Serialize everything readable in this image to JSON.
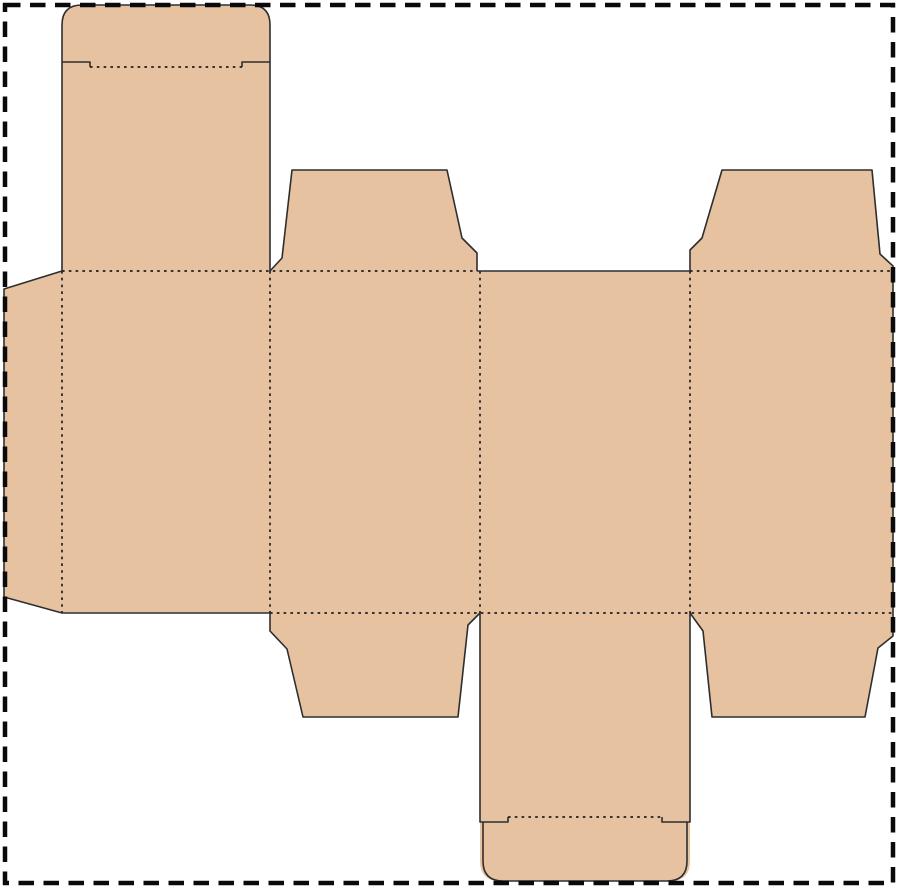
{
  "figure": {
    "kind": "packaging-dieline",
    "label": "tuck-end box dieline blank"
  },
  "colors": {
    "background": "#ffffff",
    "board": "#e6c2a1",
    "cut_line": "#2e2e2e",
    "fold_line": "#1f1f1f",
    "page_border": "#0a0a0a"
  },
  "fills": {
    "top_lid_tuck": "M62,271 L62,25 Q62,5 82,5 L250,5 Q270,5 270,25 L270,271 Z",
    "top_dust_flap_left": "M270,271 L282,258 L292,170 L447,170 L462,238 L477,253 L477,271 Z",
    "top_dust_flap_right": "M690,271 L690,250 L702,238 L722,170 L872,170 L880,254 L893,266 L893,271 Z",
    "main_panel_row": "M62,271 L893,271 L893,613 L62,613 Z",
    "glue_tab": "M62,271 L4,289 L4,597 L62,613 Z",
    "bottom_dust_flap_left": "M270,613 L270,631 L287,649 L303,717 L458,717 L468,625 L480,613 Z",
    "bottom_lid_tuck": "M480,613 L690,613 L690,861 Q690,881 670,881 L500,881 Q480,881 480,861 Z",
    "bottom_dust_flap_right": "M690,613 L703,631 L712,717 L865,717 L878,648 L893,636 L893,613 Z"
  },
  "cuts": {
    "top_lid_tuck_outline": "M62,271 L62,25 Q62,5 82,5 L250,5 Q270,5 270,25 L270,271",
    "top_tuck_notches": "M62,62 L90,62 L90,67 M270,62 L242,62 L242,67",
    "top_dust_flap_left_outline": "M270,271 L282,258 L292,170 L447,170 L462,238 L477,253 L477,271",
    "top_dust_flap_right_outline": "M690,271 L690,250 L702,238 L722,170 L872,170 L880,254 L893,266 L893,271",
    "panel3_top_edge": "M477,271 L690,271",
    "glue_tab_and_panel1_bottom": "M62,271 L4,289 L4,597 L62,613 L270,613",
    "right_edge": "M893,271 L893,613",
    "bottom_dust_flap_left_outline": "M270,613 L270,631 L287,649 L303,717 L458,717 L468,625 L480,613",
    "bottom_lid_tuck_outline": "M480,613 L480,822 L508,822 L508,817 M690,613 L690,822 L662,822 L662,817 M483,822 L483,861 Q483,881 503,881 L667,881 Q687,881 687,861 L687,822",
    "bottom_dust_flap_right_outline": "M690,613 L703,631 L712,717 L865,717 L878,648 L893,636 L893,613"
  },
  "folds": {
    "top_row_fold_left": "M62,271 L477,271",
    "top_row_fold_right": "M690,271 L893,271",
    "bottom_row_fold": "M270,613 L893,613",
    "glue_tab_fold": "M62,271 L62,613",
    "panel_fold_1": "M270,271 L270,613",
    "panel_fold_2": "M480,271 L480,613",
    "panel_fold_3": "M690,271 L690,613",
    "top_tuck_fold": "M90,67 L242,67",
    "bottom_tuck_fold": "M508,817 L662,817"
  },
  "border": {
    "outline": "M5,5 L893,5 L893,883 L5,883 Z"
  }
}
